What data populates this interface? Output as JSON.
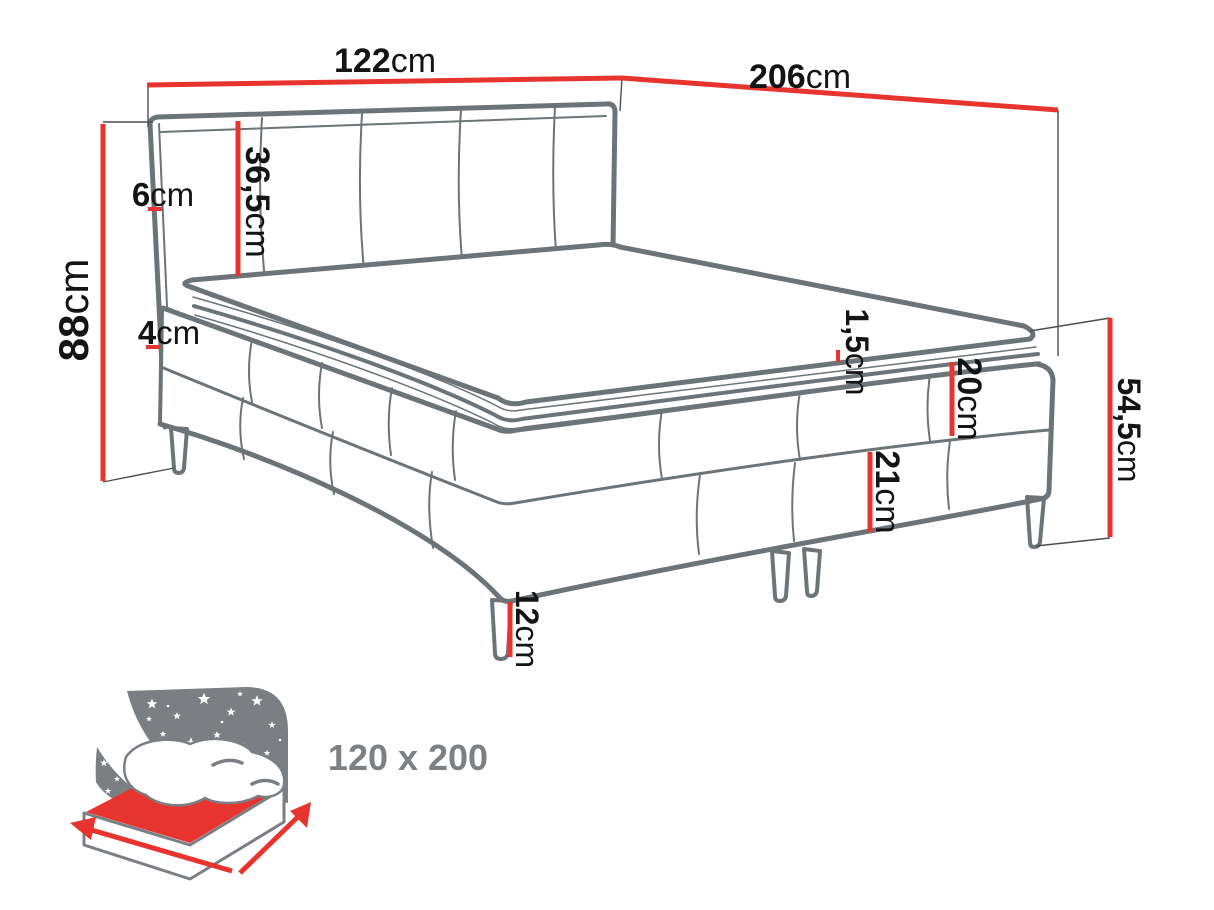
{
  "dimensions": {
    "width": {
      "value": "122",
      "unit": "cm"
    },
    "length": {
      "value": "206",
      "unit": "cm"
    },
    "total_height": {
      "value": "88",
      "unit": "cm"
    },
    "headboard_thickness": {
      "value": "6",
      "unit": "cm"
    },
    "headboard_height": {
      "value": "36,5",
      "unit": "cm"
    },
    "mattress_edge": {
      "value": "4",
      "unit": "cm"
    },
    "topper_seam": {
      "value": "1,5",
      "unit": "cm"
    },
    "upper_box_height": {
      "value": "20",
      "unit": "cm"
    },
    "lower_box_height": {
      "value": "21",
      "unit": "cm"
    },
    "side_total_height": {
      "value": "54,5",
      "unit": "cm"
    },
    "leg_height": {
      "value": "12",
      "unit": "cm"
    }
  },
  "mattress_size_label": "120 x 200",
  "colors": {
    "dimension_red": "#e8342e",
    "outline_gray": "#6d7478",
    "extension_gray": "#4d4d4d",
    "text_black": "#141414",
    "icon_gray": "#7b7f83",
    "size_text_gray": "#7e8184",
    "background": "#ffffff"
  }
}
